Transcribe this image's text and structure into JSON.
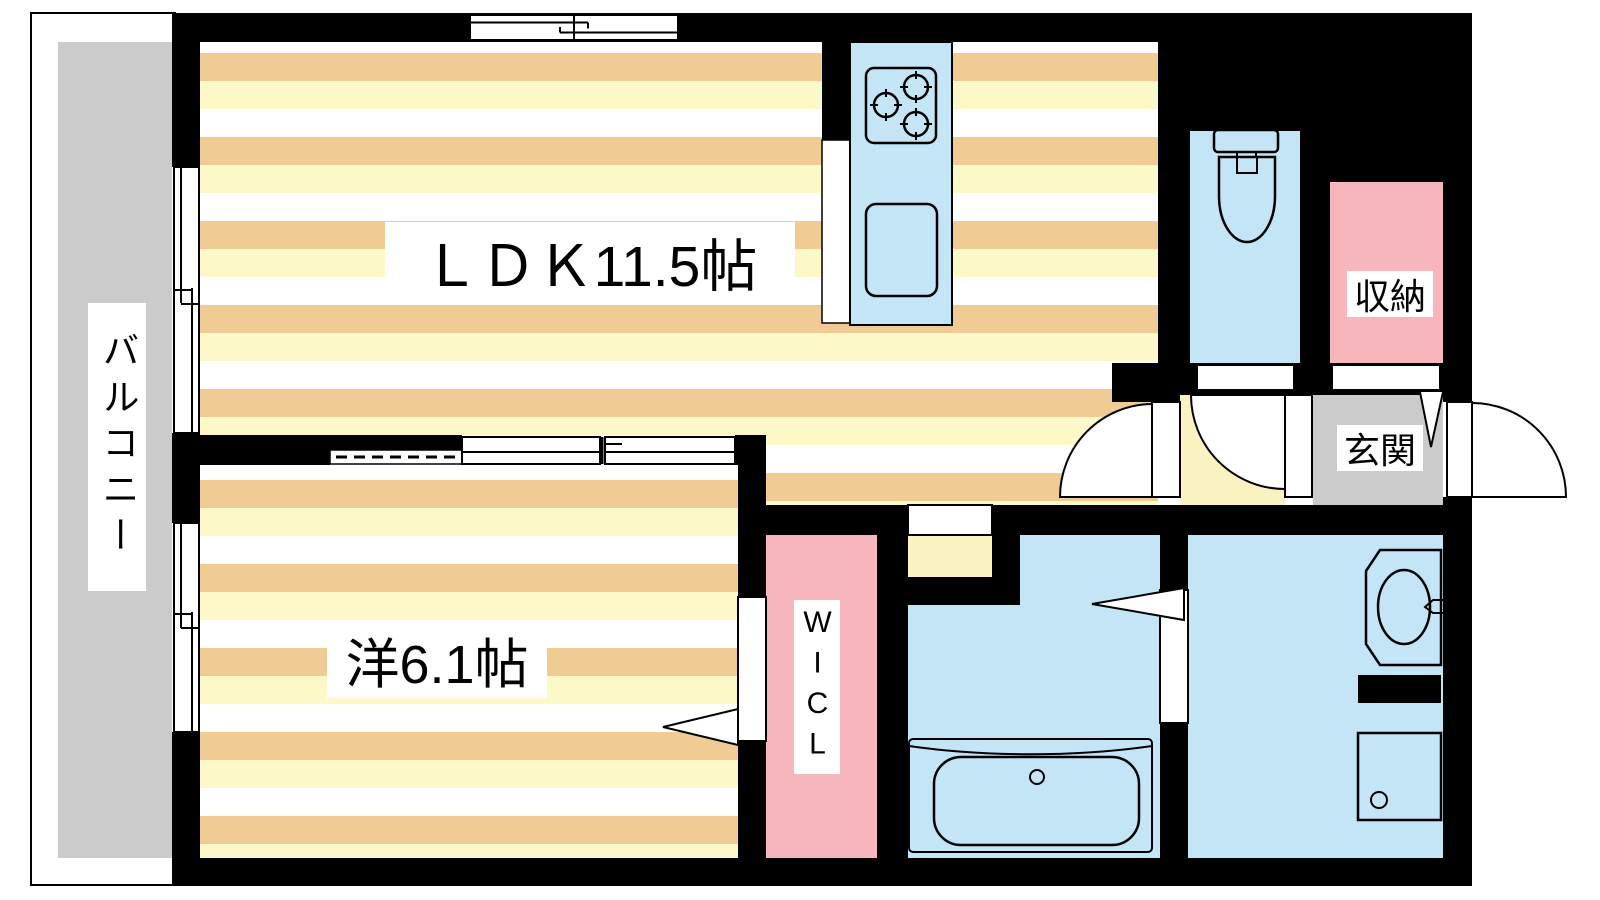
{
  "palette": {
    "wall": "#000000",
    "line": "#000000",
    "floor-tan": "#F0CC94",
    "floor-yellow": "#FDF8C8",
    "hall-yellow": "#FBF2C2",
    "water-blue": "#C3E5F6",
    "closet-pink": "#F7B5BC",
    "balcony-gray": "#CBCBCB",
    "bg": "#FFFFFF"
  },
  "rooms": {
    "ldk": {
      "label": "ＬＤＫ11.5帖"
    },
    "bedroom": {
      "label": "洋6.1帖"
    },
    "balcony": {
      "label": "バルコニー"
    },
    "storage": {
      "label": "収納"
    },
    "entrance": {
      "label": "玄関"
    },
    "walk_in_closet": {
      "label": "WICL"
    }
  },
  "fixtures": {
    "stove": "gas-stove-3-burner",
    "kitchen_sink": "kitchen-sink",
    "toilet": "toilet",
    "bathtub": "bathtub",
    "washbasin": "washbasin-with-faucet",
    "washing_machine": "washing-machine-pan"
  }
}
